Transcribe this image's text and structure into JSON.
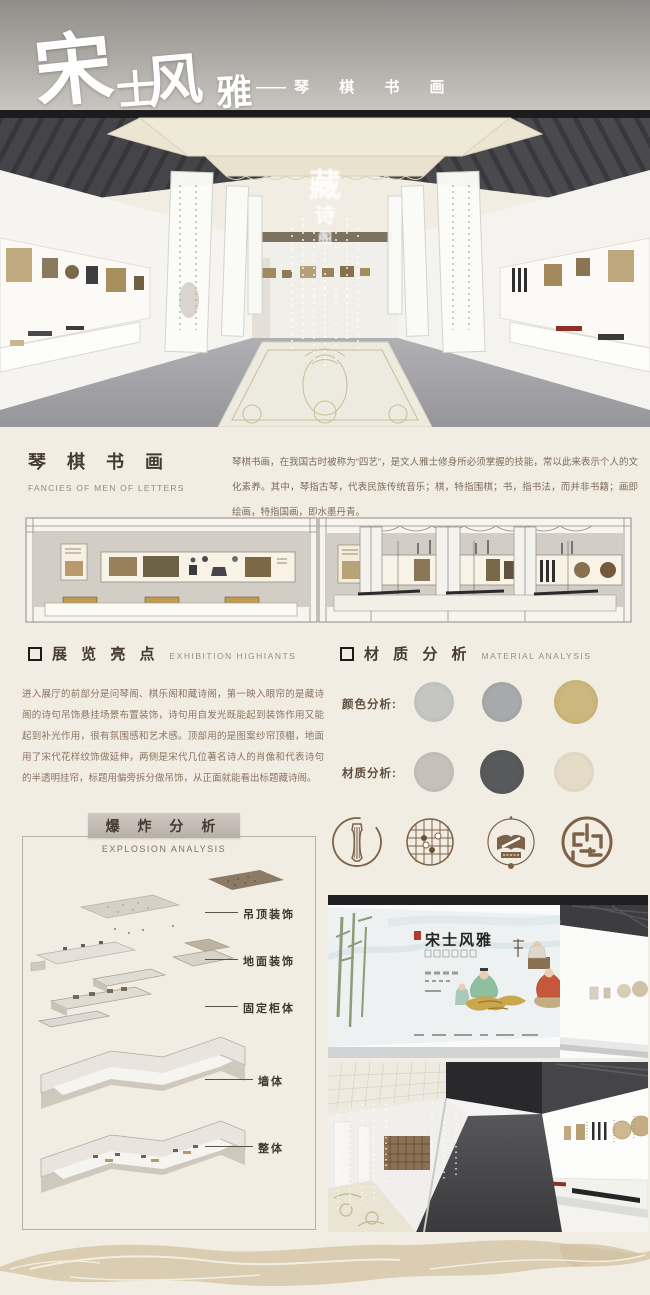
{
  "header": {
    "title_chars": [
      "宋",
      "士",
      "风",
      "雅"
    ],
    "dash": "——",
    "subtitle": "琴 棋 书 画",
    "hall_glow_chars": [
      "藏",
      "诗",
      "阁"
    ]
  },
  "intro": {
    "heading": "琴 棋 书 画",
    "heading_en": "FANCIES OF MEN OF LETTERS",
    "body": "琴棋书画，在我国古时被称为“四艺”，是文人雅士修身所必须掌握的技能，常以此来表示个人的文化素养。其中，琴指古琴，代表民族传统音乐；棋，特指围棋；书，指书法，而并非书籍；画即绘画，特指国画，即水墨丹青。"
  },
  "sections": {
    "highlights_title": "展 览 亮 点",
    "highlights_title_en": "EXHIBITION HIGHIANTS",
    "material_title": "材 质 分 析",
    "material_title_en": "MATERIAL ANALYSIS"
  },
  "highlights": {
    "body": "进入展厅的前部分是问琴阁、棋乐阁和藏诗阁，第一映入眼帘的是藏诗阁的诗句吊饰悬挂场景布置装饰，诗句用自发光既能起到装饰作用又能起到补光作用，很有氛围感和艺术感。顶部用的是图案纱帘顶棚，地面用了宋代花样纹饰做延伸，两侧是宋代几位著名诗人的肖像和代表诗句的半透明挂帘，标题用偏旁拆分做吊饰，从正面就能看出标题藏诗阁。"
  },
  "material": {
    "color_label": "颜色分析:",
    "texture_label": "材质分析:",
    "color_swatches": [
      "#c5c6c4",
      "#a7a9ab",
      "#ccb87c"
    ],
    "texture_swatches": [
      "#c7c1ba",
      "#58595b",
      "#e4dcc6"
    ]
  },
  "explosion": {
    "title": "爆 炸 分 析",
    "title_en": "EXPLOSION ANALYSIS",
    "labels": [
      "吊顶装饰",
      "地面装饰",
      "固定柜体",
      "墙体",
      "整体"
    ]
  },
  "icons": {
    "color": "#7d6248",
    "items": [
      "qin-icon",
      "go-board-icon",
      "book-brush-icon",
      "seal-icon"
    ]
  },
  "renders": {
    "entrance_title": "宋士风雅"
  }
}
